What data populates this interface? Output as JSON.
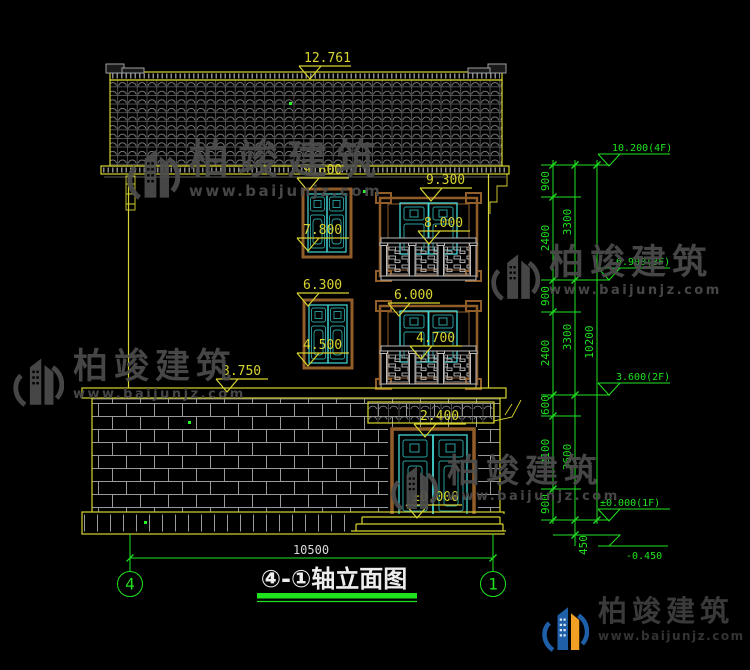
{
  "meta": {
    "title_cn": "④-①轴立面图"
  },
  "axes": {
    "left": "4",
    "right": "1"
  },
  "bottom": {
    "span": "10500"
  },
  "yellow_marks": {
    "ridge": "12.761",
    "w3t": "9.600",
    "b3t": "9.300",
    "w3b": "7.800",
    "b3r": "8.000",
    "w2t": "6.300",
    "b2t": "6.000",
    "w2b": "4.500",
    "b2r": "4.700",
    "eave": "3.750",
    "door": "2.400",
    "zero": "±0.000"
  },
  "levels": {
    "l4f": "10.200(4F)",
    "l3f": "6.900(3F)",
    "l2f": "3.600(2F)",
    "l1f": "±0.000(1F)",
    "lneg": "-0.450"
  },
  "chain": {
    "c1": [
      "900",
      "2400",
      "900",
      "2400",
      "600",
      "2100",
      "900"
    ],
    "c2": [
      "3300",
      "3300",
      "3600"
    ],
    "c3": [
      "10200"
    ],
    "c450": "450"
  },
  "watermark": {
    "brand": "柏竣建筑",
    "url": "www.baijunjz.com"
  },
  "colors": {
    "cad_yellow": "#d8d431",
    "cad_green": "#1fe31f",
    "window_cyan": "#43d6d6",
    "frame_brown": "#915d28",
    "brand_blue": "#1e5fa8",
    "brand_orange": "#f0a125"
  }
}
